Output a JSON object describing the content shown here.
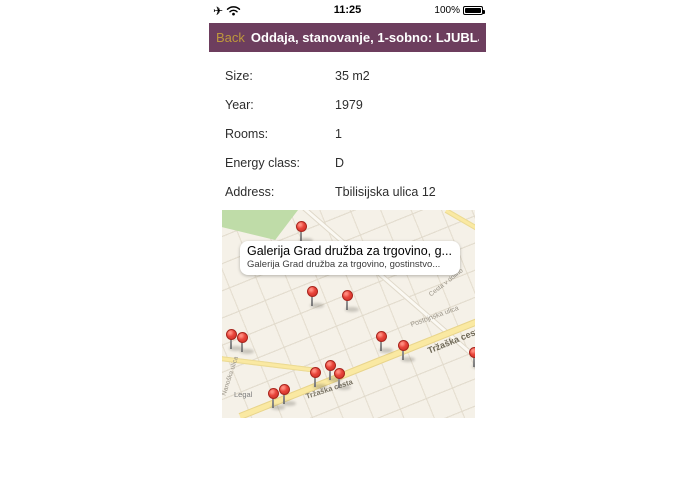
{
  "status_bar": {
    "time": "11:25",
    "battery_percent": "100%",
    "airplane_glyph": "✈"
  },
  "nav_bar": {
    "back_label": "Back",
    "title": "Oddaja, stanovanje, 1-sobno: LJUBLJ...",
    "bg_color": "#6D3E5E",
    "back_color": "#BE983C"
  },
  "details": {
    "rows": [
      {
        "label": "Size:",
        "value": "35 m2"
      },
      {
        "label": "Year:",
        "value": "1979"
      },
      {
        "label": "Rooms:",
        "value": "1"
      },
      {
        "label": "Energy class:",
        "value": "D"
      },
      {
        "label": "Address:",
        "value": "Tbilisijska ulica 12"
      }
    ]
  },
  "map": {
    "callout": {
      "title": "Galerija Grad družba za trgovino, g...",
      "subtitle": "Galerija Grad družba za trgovino, gostinstvo..."
    },
    "legal_label": "Legal",
    "colors": {
      "map_bg": "#F5F1E8",
      "park_green": "#BFDCA8",
      "road_yellow": "#FAE9A2",
      "pin_red": "#E8443A"
    },
    "street_labels": [
      {
        "text": "Tržaška cesta",
        "x": 84,
        "y": 182,
        "rotate": -18,
        "size": 7.5,
        "weight": 700,
        "color": "#7A7464"
      },
      {
        "text": "Tržaška cesta",
        "x": 206,
        "y": 136,
        "rotate": -22,
        "size": 9,
        "weight": 700,
        "color": "#6E6856"
      },
      {
        "text": "Postojnska ulica",
        "x": 189,
        "y": 112,
        "rotate": -20,
        "size": 7,
        "weight": 400,
        "color": "#9A9488"
      },
      {
        "text": "Cesta v dolino",
        "x": 208,
        "y": 82,
        "rotate": -38,
        "size": 6.5,
        "weight": 400,
        "color": "#9A9488"
      },
      {
        "text": "Nanoška ulica",
        "x": 2,
        "y": 182,
        "rotate": -72,
        "size": 6.5,
        "weight": 400,
        "color": "#9A9488"
      }
    ],
    "pins": [
      {
        "x": 79,
        "y": 16
      },
      {
        "x": 90,
        "y": 81
      },
      {
        "x": 125,
        "y": 85
      },
      {
        "x": 9,
        "y": 124
      },
      {
        "x": 20,
        "y": 127
      },
      {
        "x": 159,
        "y": 126
      },
      {
        "x": 181,
        "y": 135
      },
      {
        "x": 252,
        "y": 142
      },
      {
        "x": 108,
        "y": 155
      },
      {
        "x": 93,
        "y": 162
      },
      {
        "x": 117,
        "y": 163
      },
      {
        "x": 62,
        "y": 179
      },
      {
        "x": 51,
        "y": 183
      }
    ]
  }
}
